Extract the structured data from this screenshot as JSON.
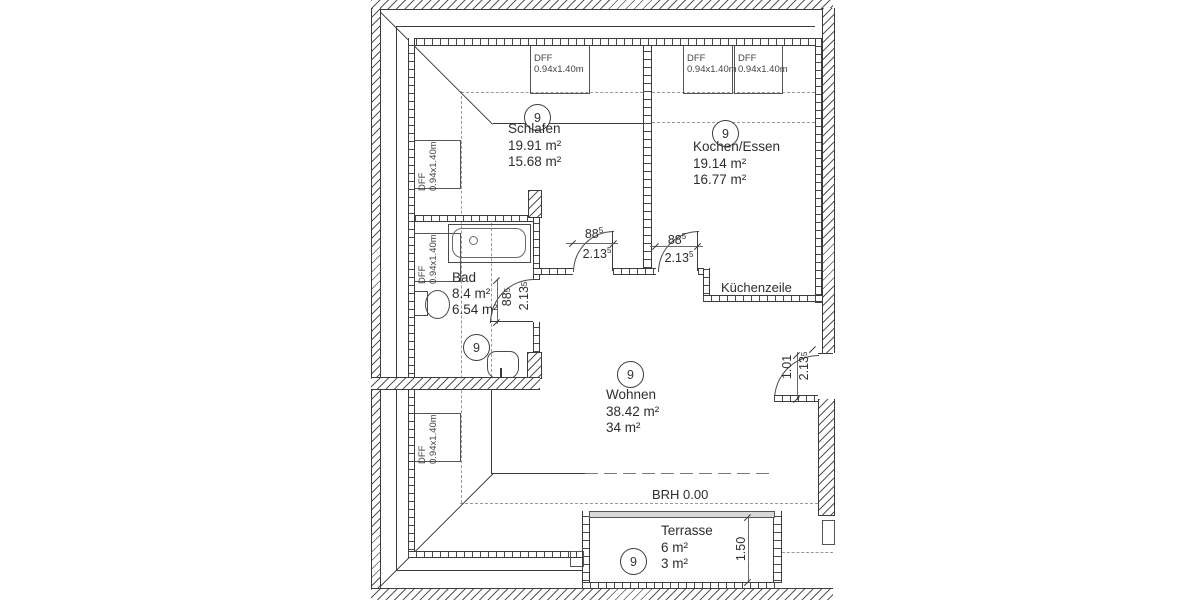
{
  "colors": {
    "wall_line": "#3c3c3c",
    "dash_line": "#9a9a9a",
    "text": "#333333",
    "glass_fill": "#d8d8d8"
  },
  "rooms": {
    "schlafen": {
      "ref": "9",
      "name": "Schlafen",
      "area_gross": "19.91 m²",
      "area_net": "15.68 m²"
    },
    "kochen": {
      "ref": "9",
      "name": "Kochen/Essen",
      "area_gross": "19.14 m²",
      "area_net": "16.77 m²"
    },
    "bad": {
      "ref": "9",
      "name": "Bad",
      "area_gross": "8.4 m²",
      "area_net": "6.54 m²"
    },
    "wohnen": {
      "ref": "9",
      "name": "Wohnen",
      "area_gross": "38.42 m²",
      "area_net": "34 m²"
    },
    "terrasse": {
      "ref": "9",
      "name": "Terrasse",
      "area_gross": "6 m²",
      "area_net": "3 m²"
    }
  },
  "windows": {
    "dff_label": "DFF",
    "dff_size": "0.94x1.40m"
  },
  "doors": {
    "schlafen": {
      "width": "88",
      "width_sup": "5",
      "height": "2.13",
      "height_sup": "5"
    },
    "kochen": {
      "width": "88",
      "width_sup": "5",
      "height": "2.13",
      "height_sup": "5"
    },
    "bad": {
      "width": "88",
      "width_sup": "5",
      "height": "2.13",
      "height_sup": "5"
    },
    "entrance": {
      "width": "1.01",
      "width_sup": "",
      "height": "2.13",
      "height_sup": "5"
    }
  },
  "annotations": {
    "kuechenzeile": "Küchenzeile",
    "brh": "BRH 0.00",
    "terrasse_depth": "1.50"
  }
}
